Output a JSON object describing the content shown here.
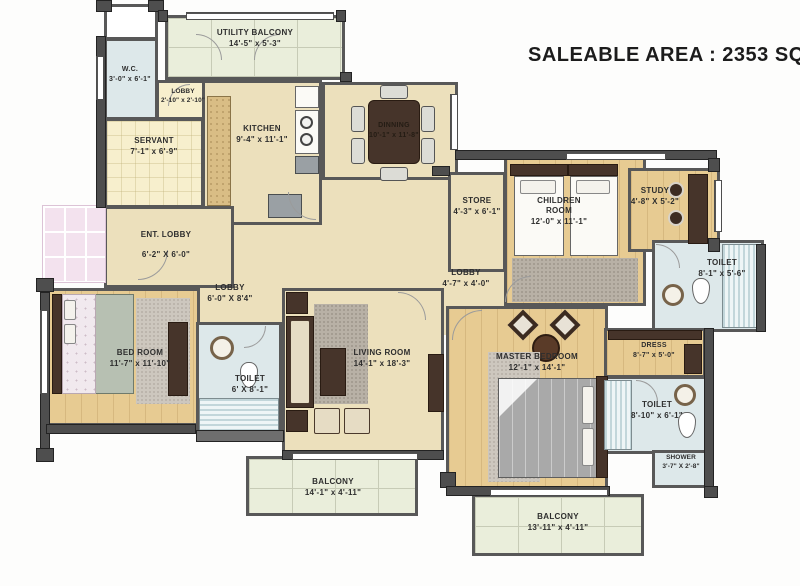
{
  "title": "SALEABLE AREA : 2353 SQ.FT",
  "rooms": [
    {
      "id": "utility_balcony",
      "name": "UTILITY BALCONY",
      "dims": "14'-5\" x 5'-3\""
    },
    {
      "id": "wc",
      "name": "W.C.",
      "dims": "3'-0\" x 6'-1\""
    },
    {
      "id": "lobby_top",
      "name": "LOBBY",
      "dims": "2'-10\" x 2'-10\""
    },
    {
      "id": "servant",
      "name": "SERVANT",
      "dims": "7'-1\" x 6'-9\""
    },
    {
      "id": "kitchen",
      "name": "KITCHEN",
      "dims": "9'-4\" x 11'-1\""
    },
    {
      "id": "dinning",
      "name": "DINNING",
      "dims": "10'-1\" x 11'-8\""
    },
    {
      "id": "ent_lobby",
      "name": "ENT. LOBBY",
      "dims": "6'-2\" X 6'-0\""
    },
    {
      "id": "store",
      "name": "STORE",
      "dims": "4'-3\" x 6'-1\""
    },
    {
      "id": "children_room",
      "name": "CHILDREN ROOM",
      "dims": "12'-0\" x 11'-1\""
    },
    {
      "id": "study",
      "name": "STUDY",
      "dims": "4'-8\" X 5'-2\""
    },
    {
      "id": "toilet_study",
      "name": "TOILET",
      "dims": "8'-1\" x 5'-6\""
    },
    {
      "id": "lobby_center",
      "name": "LOBBY",
      "dims": "4'-7\" x 4'-0\""
    },
    {
      "id": "lobby_left",
      "name": "LOBBY",
      "dims": "6'-0\" X 8'4\""
    },
    {
      "id": "bed_room",
      "name": "BED ROOM",
      "dims": "11'-7\" x 11'-10\""
    },
    {
      "id": "toilet_bed",
      "name": "TOILET",
      "dims": "6' X 8'-1\""
    },
    {
      "id": "living_room",
      "name": "LIVING ROOM",
      "dims": "14'-1\" x 18'-3\""
    },
    {
      "id": "master_bedroom",
      "name": "MASTER BEDROOM",
      "dims": "12'-1\" x 14'-1\""
    },
    {
      "id": "dress",
      "name": "DRESS",
      "dims": "8'-7\" x 5'-0\""
    },
    {
      "id": "toilet_master",
      "name": "TOILET",
      "dims": "8'-10\" x 6'-1\""
    },
    {
      "id": "shower",
      "name": "SHOWER",
      "dims": "3'-7\" X 2'-8\""
    },
    {
      "id": "balcony_left",
      "name": "BALCONY",
      "dims": "14'-1\" x 4'-11\""
    },
    {
      "id": "balcony_right",
      "name": "BALCONY",
      "dims": "13'-11\" x 4'-11\""
    }
  ],
  "palette": {
    "wall": "#4e4e4e",
    "floor_beige": "#ece0bc",
    "floor_wood": "#e7cb92",
    "toilet_blue": "#dde8ea",
    "balcony_green": "#eaeedb",
    "cream": "#f7efcd",
    "pink_deck": "#f3e2ee",
    "furniture_brown": "#46342a",
    "text": "#2e2e2e"
  }
}
